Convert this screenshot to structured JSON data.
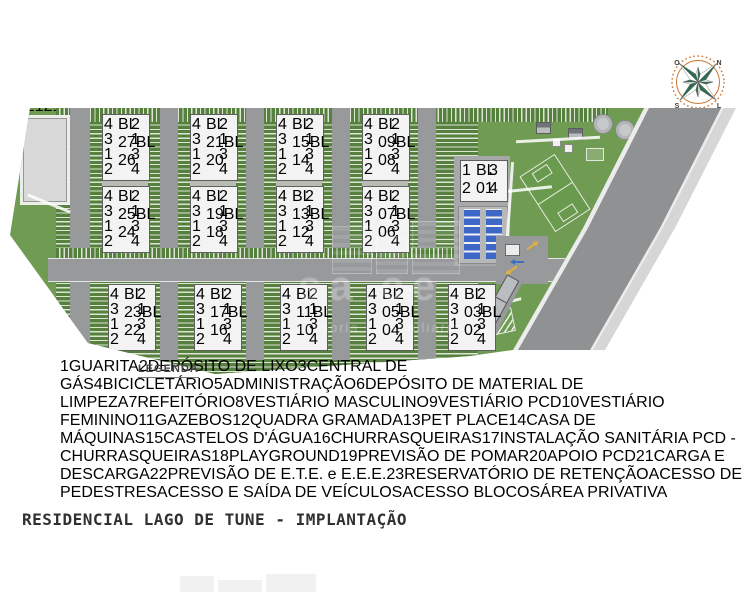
{
  "page_title": "RESIDENCIAL LAGO DE TUNE - IMPLANTAÇÃO",
  "compass": {
    "north": "N",
    "east": "L",
    "south": "S",
    "west": "O"
  },
  "watermark": {
    "line1": "sa ce",
    "line2": "acessoria + imobiliaria"
  },
  "legend": {
    "title": "LEGENDA",
    "columns": [
      [
        {
          "n": "1",
          "label": "GUARITA"
        },
        {
          "n": "2",
          "label": "DEPÓSITO DE LIXO"
        },
        {
          "n": "3",
          "label": "CENTRAL DE GÁS"
        },
        {
          "n": "4",
          "label": "BICICLETÁRIO"
        },
        {
          "n": "5",
          "label": "ADMINISTRAÇÃO"
        },
        {
          "n": "6",
          "label": "DEPÓSITO DE MATERIAL DE LIMPEZA"
        },
        {
          "n": "7",
          "label": "REFEITÓRIO"
        }
      ],
      [
        {
          "n": "8",
          "label": "VESTIÁRIO MASCULINO"
        },
        {
          "n": "9",
          "label": "VESTIÁRIO PCD"
        },
        {
          "n": "10",
          "label": "VESTIÁRIO FEMININO"
        },
        {
          "n": "11",
          "label": "GAZEBOS"
        },
        {
          "n": "12",
          "label": "QUADRA GRAMADA"
        },
        {
          "n": "13",
          "label": "PET PLACE"
        },
        {
          "n": "14",
          "label": "CASA DE MÁQUINAS"
        }
      ],
      [
        {
          "n": "15",
          "label": "CASTELOS D'ÁGUA"
        },
        {
          "n": "16",
          "label": "CHURRASQUEIRAS"
        },
        {
          "n": "17",
          "label": "INSTALAÇÃO SANITÁRIA PCD - CHURRASQUEIRAS"
        },
        {
          "n": "18",
          "label": "PLAYGROUND"
        },
        {
          "n": "19",
          "label": "PREVISÃO DE POMAR"
        },
        {
          "n": "20",
          "label": "APOIO PCD"
        }
      ],
      [
        {
          "n": "21",
          "label": "CARGA E DESCARGA"
        },
        {
          "n": "22",
          "label": "PREVISÃO DE E.T.E. e E.E.E."
        },
        {
          "n": "23",
          "label": "RESERVATÓRIO DE RETENÇÃO"
        }
      ]
    ],
    "symbols": [
      {
        "type": "arrow-blue",
        "label": "ACESSO DE PEDESTRES",
        "color": "#3f6fc0"
      },
      {
        "type": "arrow-yellow",
        "label": "ACESSO E SAÍDA DE VEÍCULOS",
        "color": "#e2b13c"
      },
      {
        "type": "triangle-red",
        "label": "ACESSO BLOCOS",
        "color": "#c62828"
      },
      {
        "type": "dot-red",
        "label": "ÁREA PRIVATIVA",
        "color": "#c62828"
      }
    ]
  },
  "plan": {
    "colors": {
      "grass": "#6f9b52",
      "road": "#97999b",
      "street": "#8f9193",
      "block": "#dadbdd",
      "unit_number": "#3848b4",
      "marker_red": "#c03030",
      "parking_stripe": "#55803e"
    },
    "unit_numbers_left": [
      "4",
      "3",
      "1",
      "2"
    ],
    "unit_numbers_right": [
      "2",
      "1",
      "3",
      "4"
    ],
    "blocks": [
      {
        "x": 94,
        "y": 16,
        "top": "BL\n27",
        "bottom": "BL\n26"
      },
      {
        "x": 182,
        "y": 16,
        "top": "BL\n21",
        "bottom": "BL\n20"
      },
      {
        "x": 268,
        "y": 16,
        "top": "BL\n15",
        "bottom": "BL\n14"
      },
      {
        "x": 354,
        "y": 16,
        "top": "BL\n09",
        "bottom": "BL\n08"
      },
      {
        "x": 94,
        "y": 88,
        "top": "BL\n25",
        "bottom": "BL\n24"
      },
      {
        "x": 182,
        "y": 88,
        "top": "BL\n19",
        "bottom": "BL\n18"
      },
      {
        "x": 268,
        "y": 88,
        "top": "BL\n13",
        "bottom": "BL\n12"
      },
      {
        "x": 354,
        "y": 88,
        "top": "BL\n07",
        "bottom": "BL\n06"
      },
      {
        "x": 100,
        "y": 186,
        "top": "BL\n23",
        "bottom": "BL\n22"
      },
      {
        "x": 186,
        "y": 186,
        "top": "BL\n17",
        "bottom": "BL\n16"
      },
      {
        "x": 272,
        "y": 186,
        "top": "BL\n11",
        "bottom": "BL\n10"
      },
      {
        "x": 358,
        "y": 186,
        "top": "BL\n05",
        "bottom": "BL\n04"
      },
      {
        "x": 440,
        "y": 186,
        "top": "BL\n03",
        "bottom": "BL\n02"
      }
    ],
    "support_block": {
      "x": 452,
      "y": 62,
      "label": "BL\n01",
      "units_left": [
        "1",
        "2"
      ],
      "units_right": [
        "3",
        "4"
      ]
    },
    "markers": [
      {
        "n": "23",
        "x": 36,
        "y": 54
      },
      {
        "n": "21",
        "x": 74,
        "y": 52
      },
      {
        "n": "21",
        "x": 176,
        "y": 32
      },
      {
        "n": "21",
        "x": 161,
        "y": 152
      },
      {
        "n": "21",
        "x": 247,
        "y": 152
      },
      {
        "n": "21",
        "x": 333,
        "y": 152
      },
      {
        "n": "21",
        "x": 419,
        "y": 152
      },
      {
        "n": "19",
        "x": 470,
        "y": 36
      },
      {
        "n": "14",
        "x": 527,
        "y": 54
      },
      {
        "n": "16",
        "x": 538,
        "y": 22
      },
      {
        "n": "17",
        "x": 576,
        "y": 28
      },
      {
        "n": "11",
        "x": 550,
        "y": 36
      },
      {
        "n": "13",
        "x": 586,
        "y": 52
      },
      {
        "n": "15",
        "x": 594,
        "y": 18
      },
      {
        "n": "15",
        "x": 616,
        "y": 24
      },
      {
        "n": "12",
        "x": 554,
        "y": 98
      },
      {
        "n": "5",
        "x": 510,
        "y": 104
      },
      {
        "n": "6",
        "x": 524,
        "y": 107
      },
      {
        "n": "7",
        "x": 538,
        "y": 110
      },
      {
        "n": "8",
        "x": 510,
        "y": 117
      },
      {
        "n": "9",
        "x": 524,
        "y": 120
      },
      {
        "n": "10",
        "x": 538,
        "y": 123
      },
      {
        "n": "20",
        "x": 514,
        "y": 131
      },
      {
        "n": "18",
        "x": 530,
        "y": 134
      },
      {
        "n": "22",
        "x": 478,
        "y": 228
      },
      {
        "n": "4",
        "x": 470,
        "y": 188
      },
      {
        "n": "1",
        "x": 506,
        "y": 143
      },
      {
        "n": "2",
        "x": 497,
        "y": 187
      },
      {
        "n": "3",
        "x": 486,
        "y": 209
      }
    ],
    "trees": [
      [
        448,
        22
      ],
      [
        466,
        16
      ],
      [
        484,
        22
      ],
      [
        456,
        38
      ],
      [
        475,
        40
      ],
      [
        448,
        54
      ],
      [
        468,
        56
      ],
      [
        486,
        50
      ],
      [
        502,
        20
      ],
      [
        495,
        36
      ]
    ],
    "cars": [
      {
        "x": 138,
        "y": 28,
        "c": "#a03030",
        "o": "h"
      },
      {
        "x": 66,
        "y": 128,
        "c": "#3c3c3c",
        "o": "v"
      },
      {
        "x": 148,
        "y": 72,
        "c": "#e8e8e8",
        "o": "h"
      },
      {
        "x": 248,
        "y": 166,
        "c": "#2f2f2f",
        "o": "h"
      },
      {
        "x": 420,
        "y": 166,
        "c": "#ececec",
        "o": "h"
      },
      {
        "x": 362,
        "y": 28,
        "c": "#8a8a8a",
        "o": "h"
      },
      {
        "x": 230,
        "y": 100,
        "c": "#2f2f2f",
        "o": "v"
      },
      {
        "x": 108,
        "y": 170,
        "c": "#a03030",
        "o": "h"
      }
    ],
    "street_cars": [
      {
        "x": 650,
        "y": 48,
        "c": "#9b2f2f"
      },
      {
        "x": 584,
        "y": 178,
        "c": "#3a3a3a"
      }
    ]
  }
}
